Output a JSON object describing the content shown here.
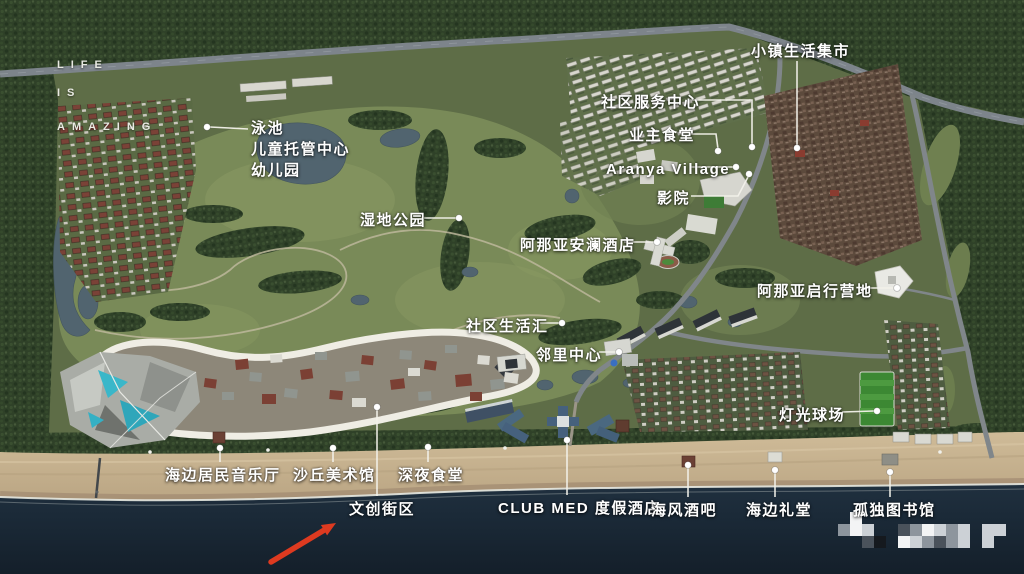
{
  "map_title": "resort-masterplan-aerial-map",
  "slogan": {
    "x": 57,
    "lines": [
      {
        "text": "LIFE",
        "y": 59
      },
      {
        "text": "IS",
        "y": 87
      },
      {
        "text": "AMAZING",
        "y": 121
      }
    ]
  },
  "labels": [
    {
      "id": "pool-daycare-kindergarten",
      "lines": [
        "泳池",
        "儿童托管中心",
        "幼儿园"
      ],
      "x": 251,
      "y": 118,
      "leader": [
        [
          248,
          129
        ],
        [
          210,
          127
        ]
      ],
      "dot": [
        207,
        127
      ]
    },
    {
      "id": "town-life-market",
      "text": "小镇生活集市",
      "x": 751,
      "y": 41,
      "leader": [
        [
          797,
          61
        ],
        [
          797,
          146
        ]
      ],
      "dot": [
        797,
        148
      ]
    },
    {
      "id": "community-service-center",
      "text": "社区服务中心",
      "x": 601,
      "y": 92,
      "leader": [
        [
          690,
          100
        ],
        [
          752,
          100
        ],
        [
          752,
          145
        ]
      ],
      "dot": [
        752,
        147
      ]
    },
    {
      "id": "owners-canteen",
      "text": "业主食堂",
      "x": 629,
      "y": 125,
      "leader": [
        [
          689,
          134
        ],
        [
          716,
          134
        ],
        [
          718,
          149
        ]
      ],
      "dot": [
        718,
        151
      ]
    },
    {
      "id": "aranya-village",
      "text": "Aranya Village",
      "x": 606,
      "y": 159,
      "leader": [
        [
          691,
          167
        ],
        [
          733,
          167
        ]
      ],
      "dot": [
        736,
        167
      ]
    },
    {
      "id": "cinema",
      "text": "影院",
      "x": 657,
      "y": 188,
      "leader": [
        [
          691,
          196
        ],
        [
          738,
          196
        ],
        [
          748,
          177
        ]
      ],
      "dot": [
        749,
        174
      ]
    },
    {
      "id": "wetland-park",
      "text": "湿地公园",
      "x": 360,
      "y": 210,
      "leader": [
        [
          424,
          218
        ],
        [
          456,
          218
        ]
      ],
      "dot": [
        459,
        218
      ]
    },
    {
      "id": "anlan-hotel",
      "text": "阿那亚安澜酒店",
      "x": 520,
      "y": 235,
      "leader": [
        [
          624,
          242
        ],
        [
          654,
          242
        ]
      ],
      "dot": [
        657,
        242
      ]
    },
    {
      "id": "community-life-hub",
      "text": "社区生活汇",
      "x": 466,
      "y": 316,
      "leader": [
        [
          540,
          323
        ],
        [
          559,
          323
        ]
      ],
      "dot": [
        562,
        323
      ]
    },
    {
      "id": "neighborhood-center",
      "text": "邻里中心",
      "x": 536,
      "y": 345,
      "leader": [
        [
          599,
          352
        ],
        [
          616,
          352
        ]
      ],
      "dot": [
        619,
        352
      ]
    },
    {
      "id": "qixing-camp",
      "text": "阿那亚启行营地",
      "x": 757,
      "y": 281,
      "leader": [
        [
          861,
          288
        ],
        [
          894,
          288
        ]
      ],
      "dot": [
        897,
        288
      ]
    },
    {
      "id": "floodlit-pitch",
      "text": "灯光球场",
      "x": 779,
      "y": 405,
      "leader": [
        [
          842,
          412
        ],
        [
          874,
          411
        ]
      ],
      "dot": [
        877,
        411
      ]
    },
    {
      "id": "seaside-concert-hall",
      "text": "海边居民音乐厅",
      "x": 165,
      "y": 465,
      "leader": [
        [
          220,
          462
        ],
        [
          220,
          451
        ]
      ],
      "dot": [
        220,
        448
      ]
    },
    {
      "id": "dune-art-museum",
      "text": "沙丘美术馆",
      "x": 293,
      "y": 465,
      "leader": [
        [
          333,
          462
        ],
        [
          333,
          451
        ]
      ],
      "dot": [
        333,
        448
      ]
    },
    {
      "id": "midnight-canteen",
      "text": "深夜食堂",
      "x": 398,
      "y": 465,
      "leader": [
        [
          428,
          462
        ],
        [
          428,
          450
        ]
      ],
      "dot": [
        428,
        447
      ]
    },
    {
      "id": "creative-street",
      "text": "文创街区",
      "x": 349,
      "y": 499,
      "leader": [
        [
          377,
          496
        ],
        [
          377,
          409
        ]
      ],
      "dot": [
        377,
        407
      ]
    },
    {
      "id": "club-med-resort",
      "text": "CLUB MED 度假酒店",
      "x": 498,
      "y": 498,
      "leader": [
        [
          567,
          495
        ],
        [
          567,
          443
        ]
      ],
      "dot": [
        567,
        440
      ]
    },
    {
      "id": "sea-breeze-bar",
      "text": "海风酒吧",
      "x": 651,
      "y": 500,
      "leader": [
        [
          688,
          497
        ],
        [
          688,
          468
        ]
      ],
      "dot": [
        688,
        465
      ]
    },
    {
      "id": "seaside-chapel",
      "text": "海边礼堂",
      "x": 746,
      "y": 500,
      "leader": [
        [
          775,
          497
        ],
        [
          775,
          473
        ]
      ],
      "dot": [
        775,
        470
      ]
    },
    {
      "id": "lonely-library",
      "text": "孤独图书馆",
      "x": 853,
      "y": 500,
      "leader": [
        [
          890,
          497
        ],
        [
          890,
          475
        ]
      ],
      "dot": [
        890,
        472
      ]
    }
  ],
  "arrow": {
    "color": "#dd3a20",
    "tail": [
      271,
      562
    ],
    "head": [
      336,
      523
    ],
    "points_to": "文创街区"
  },
  "watermark": {
    "origin": [
      838,
      512
    ],
    "cell": 12,
    "palette": [
      "#f3f4f5",
      "#ccd1d6",
      "#8d959d",
      "#4a525b",
      "#15191e"
    ],
    "cells": [
      [
        1,
        0,
        0
      ],
      [
        0,
        1,
        2
      ],
      [
        1,
        1,
        0
      ],
      [
        2,
        1,
        1
      ],
      [
        5,
        1,
        3
      ],
      [
        6,
        1,
        2
      ],
      [
        7,
        1,
        0
      ],
      [
        8,
        1,
        1
      ],
      [
        9,
        1,
        2
      ],
      [
        10,
        1,
        1
      ],
      [
        12,
        1,
        1
      ],
      [
        13,
        1,
        1
      ],
      [
        2,
        2,
        3
      ],
      [
        3,
        2,
        4
      ],
      [
        5,
        2,
        0
      ],
      [
        6,
        2,
        1
      ],
      [
        7,
        2,
        2
      ],
      [
        8,
        2,
        3
      ],
      [
        9,
        2,
        2
      ],
      [
        10,
        2,
        1
      ],
      [
        12,
        2,
        1
      ]
    ]
  },
  "colors": {
    "sea": "#1c2b3a",
    "sand": "#c9b593",
    "forest": "#2f4128",
    "meadow": "#798a58",
    "leader": "#f2f1ea",
    "label_text": "#ffffff",
    "loop_road": "#efede4",
    "pool_cyan": "#38b4c7",
    "arrow_red": "#dd3a20"
  }
}
